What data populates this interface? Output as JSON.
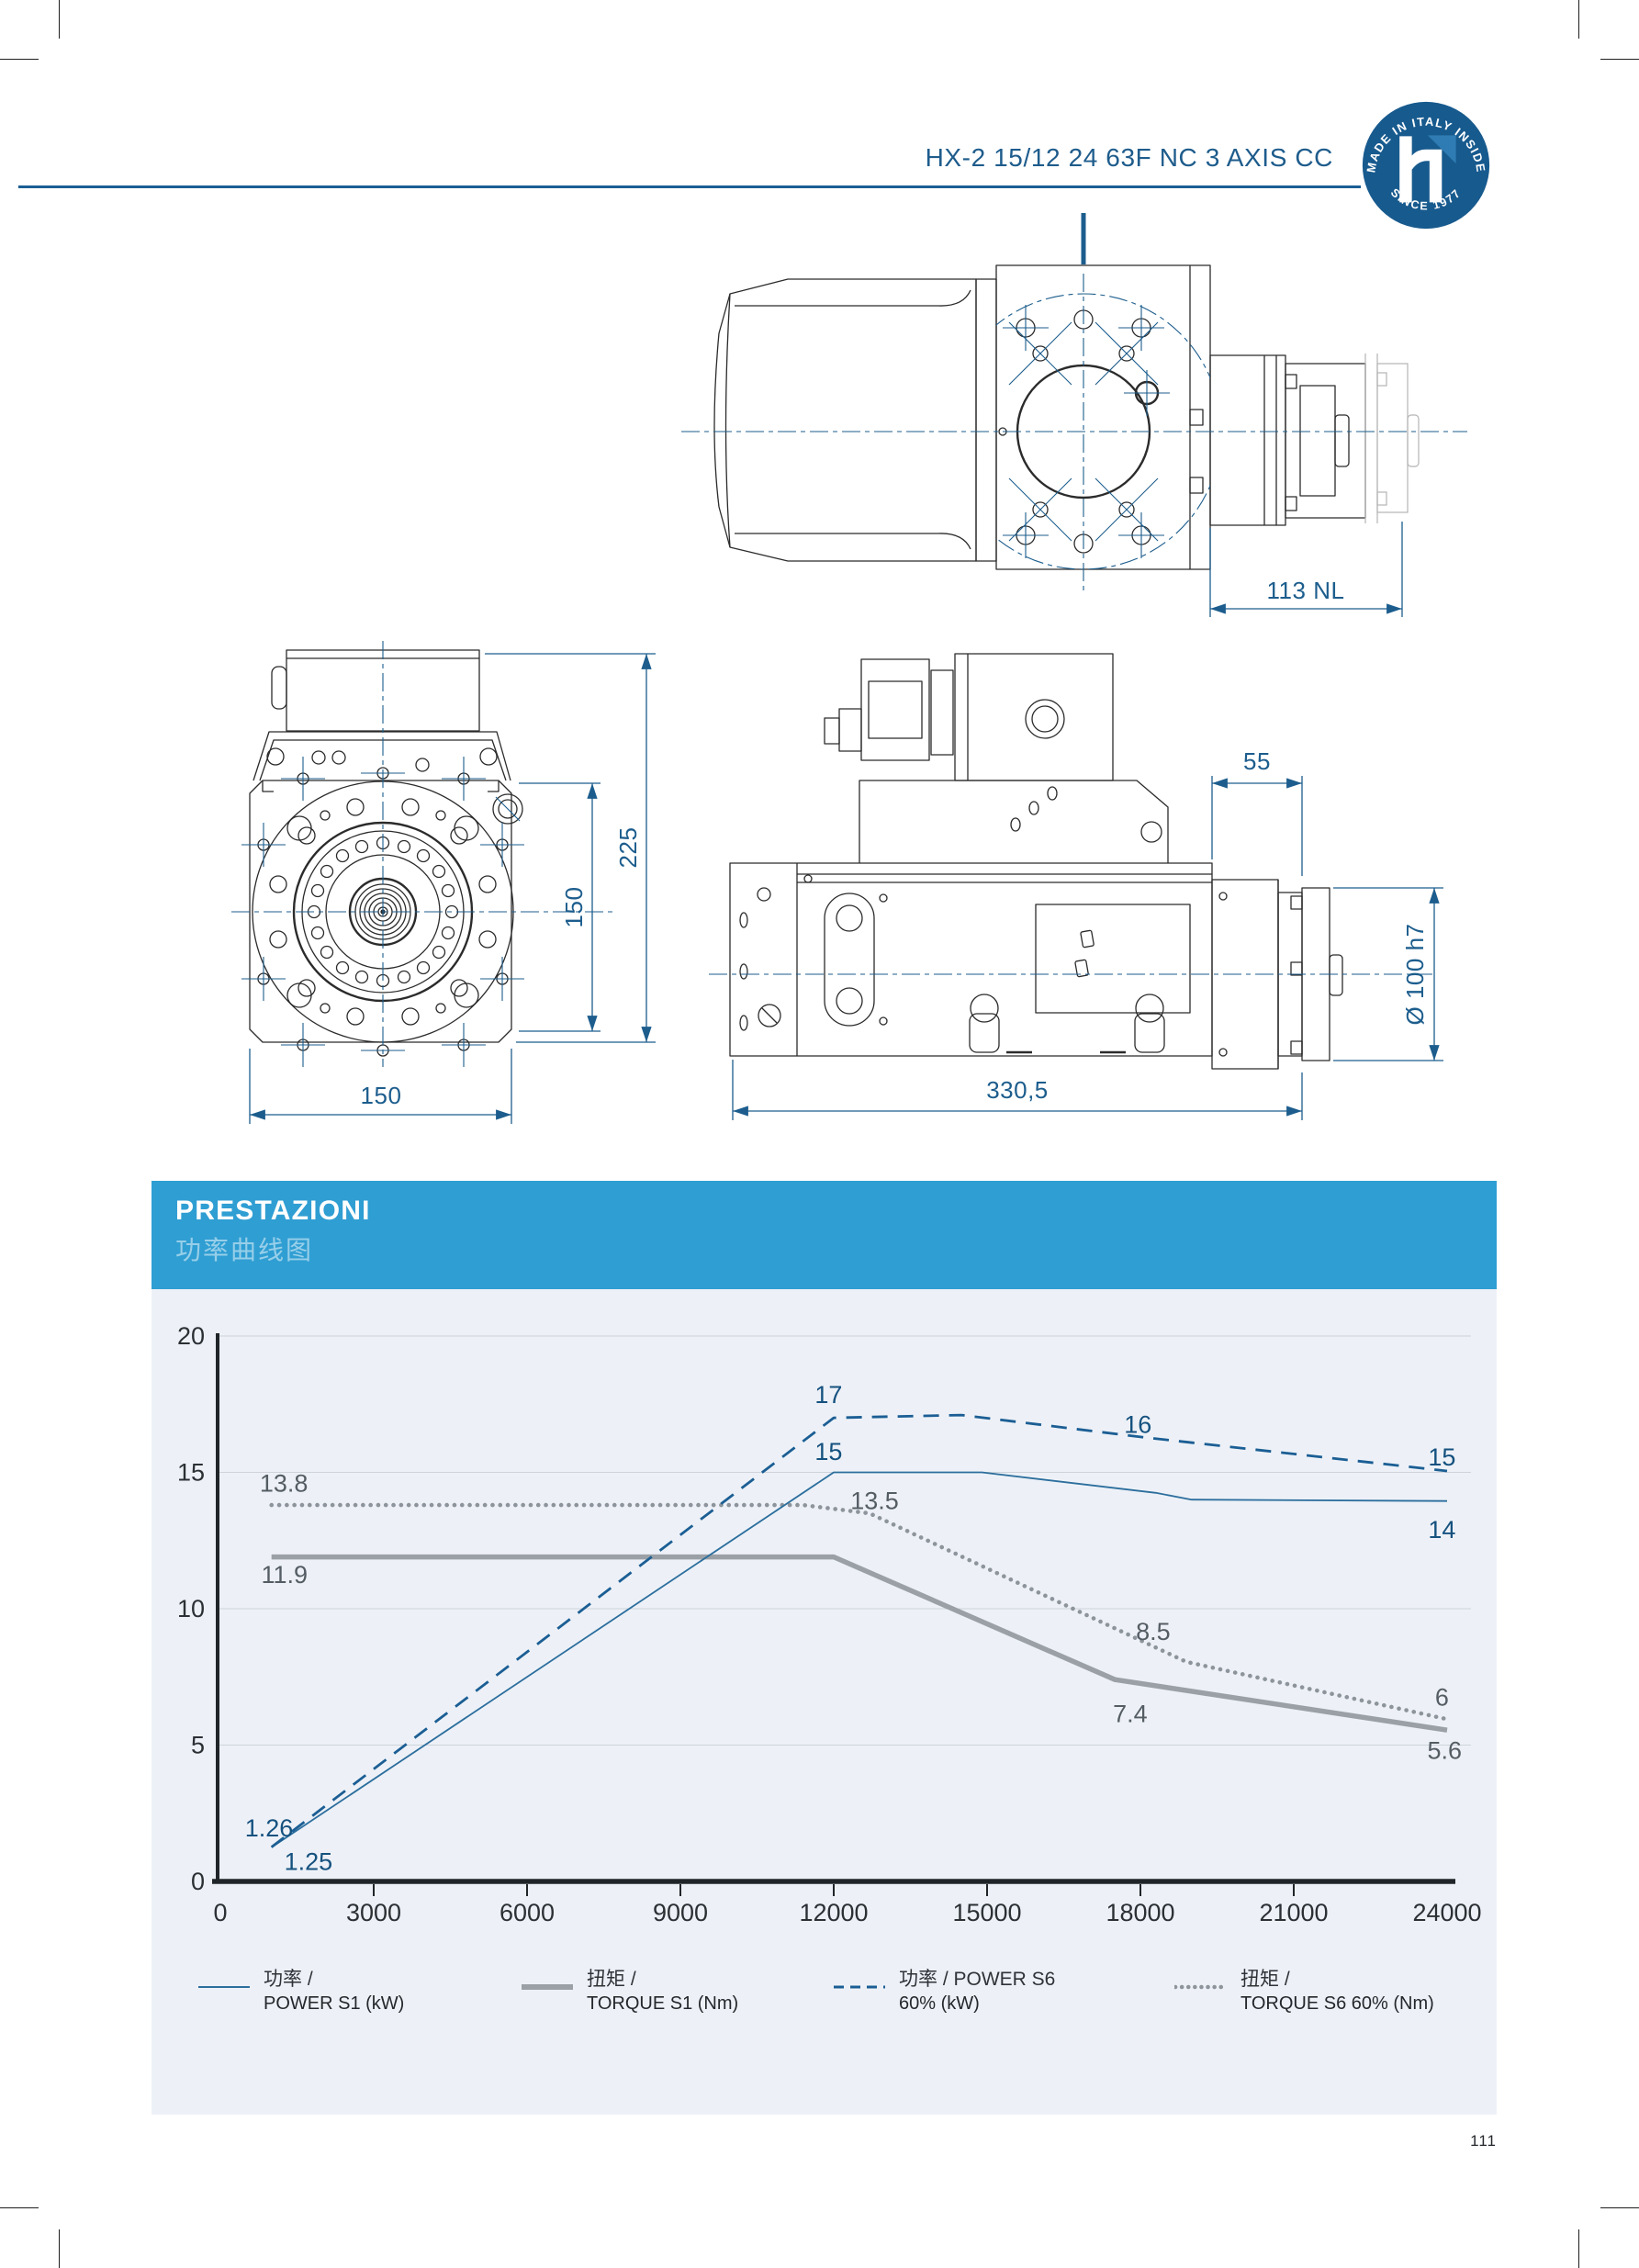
{
  "header": {
    "model": "HX-2 15/12 24 63F NC 3 AXIS CC",
    "badge": {
      "arc_top": "MADE IN ITALY INSIDE",
      "arc_bottom": "SINCE 1977",
      "logo": "h-logo",
      "color": "#175a8e"
    }
  },
  "drawings": {
    "top_view": {
      "length_label": "113 NL"
    },
    "front_view": {
      "total_height_label": "225",
      "flange_height_label": "150",
      "width_label": "150"
    },
    "side_view": {
      "nose_length_label": "55",
      "shaft_diameter_label": "Ø 100 h7",
      "total_length_label": "330,5"
    }
  },
  "chart_section": {
    "title": "PRESTAZIONI",
    "subtitle": "功率曲线图",
    "legend": [
      {
        "kind": "solid_thin",
        "line1": "功率 /",
        "line2": "POWER S1 (kW)"
      },
      {
        "kind": "solid_thick",
        "line1": "扭矩 /",
        "line2": "TORQUE S1 (Nm)"
      },
      {
        "kind": "dashed",
        "line1": "功率 / POWER S6",
        "line2": "60% (kW)"
      },
      {
        "kind": "dotted",
        "line1": "扭矩 /",
        "line2": "TORQUE S6 60% (Nm)"
      }
    ]
  },
  "chart_data": {
    "type": "line",
    "title": "PRESTAZIONI",
    "xlabel": "",
    "ylabel": "",
    "x": {
      "min": 0,
      "max": 24000,
      "ticks": [
        0,
        3000,
        6000,
        9000,
        12000,
        15000,
        18000,
        21000,
        24000
      ]
    },
    "y": {
      "min": 0,
      "max": 20,
      "ticks": [
        0,
        5,
        10,
        15,
        20
      ]
    },
    "grid": "horizontal",
    "legend_position": "bottom",
    "colors": {
      "blue": "#15517f",
      "gray": "#555d64",
      "power_s1": "#2c6e9d",
      "torque_s1": "#9aa0a5",
      "power_s6": "#1b5e94",
      "torque_s6": "#8d949b"
    },
    "series": [
      {
        "name": "TORQUE S6 60% (Nm)",
        "style": "dotted",
        "color_key": "torque_s6",
        "points": [
          [
            1000,
            13.8
          ],
          [
            11400,
            13.8
          ],
          [
            12700,
            13.5
          ],
          [
            18900,
            8.05
          ],
          [
            24000,
            5.95
          ]
        ]
      },
      {
        "name": "TORQUE S1 (Nm)",
        "style": "solid_thick",
        "color_key": "torque_s1",
        "points": [
          [
            1000,
            11.9
          ],
          [
            12000,
            11.9
          ],
          [
            17500,
            7.4
          ],
          [
            24000,
            5.55
          ]
        ]
      },
      {
        "name": "POWER S1 (kW)",
        "style": "solid_thin",
        "color_key": "power_s1",
        "points": [
          [
            1000,
            1.25
          ],
          [
            12000,
            15
          ],
          [
            14900,
            15
          ],
          [
            18300,
            14.25
          ],
          [
            19000,
            14.0
          ],
          [
            24000,
            13.95
          ]
        ]
      },
      {
        "name": "POWER S6 60% (kW)",
        "style": "dashed",
        "color_key": "power_s6",
        "points": [
          [
            1000,
            1.26
          ],
          [
            12000,
            17.0
          ],
          [
            14500,
            17.1
          ],
          [
            18000,
            16.3
          ],
          [
            24000,
            15.05
          ]
        ]
      }
    ],
    "annotations": [
      {
        "text": "13.8",
        "x": 770,
        "y": 14.6,
        "color": "gray",
        "anchor": "start"
      },
      {
        "text": "11.9",
        "x": 800,
        "y": 11.25,
        "color": "gray",
        "anchor": "start"
      },
      {
        "text": "1.26",
        "x": 480,
        "y": 1.95,
        "color": "blue",
        "anchor": "start"
      },
      {
        "text": "1.25",
        "x": 1250,
        "y": 0.72,
        "color": "blue",
        "anchor": "start"
      },
      {
        "text": "17",
        "x": 11900,
        "y": 17.85,
        "color": "blue",
        "anchor": "middle"
      },
      {
        "text": "15",
        "x": 11900,
        "y": 15.75,
        "color": "blue",
        "anchor": "middle"
      },
      {
        "text": "13.5",
        "x": 12800,
        "y": 13.95,
        "color": "gray",
        "anchor": "middle"
      },
      {
        "text": "16",
        "x": 17950,
        "y": 16.75,
        "color": "blue",
        "anchor": "middle"
      },
      {
        "text": "8.5",
        "x": 18250,
        "y": 9.15,
        "color": "gray",
        "anchor": "middle"
      },
      {
        "text": "7.4",
        "x": 17800,
        "y": 6.15,
        "color": "gray",
        "anchor": "middle"
      },
      {
        "text": "15",
        "x": 23900,
        "y": 15.55,
        "color": "blue",
        "anchor": "middle"
      },
      {
        "text": "14",
        "x": 23900,
        "y": 12.9,
        "color": "blue",
        "anchor": "middle"
      },
      {
        "text": "6",
        "x": 23900,
        "y": 6.75,
        "color": "gray",
        "anchor": "middle"
      },
      {
        "text": "5.6",
        "x": 23950,
        "y": 4.8,
        "color": "gray",
        "anchor": "middle"
      }
    ]
  },
  "footer": {
    "page_number": "111"
  }
}
